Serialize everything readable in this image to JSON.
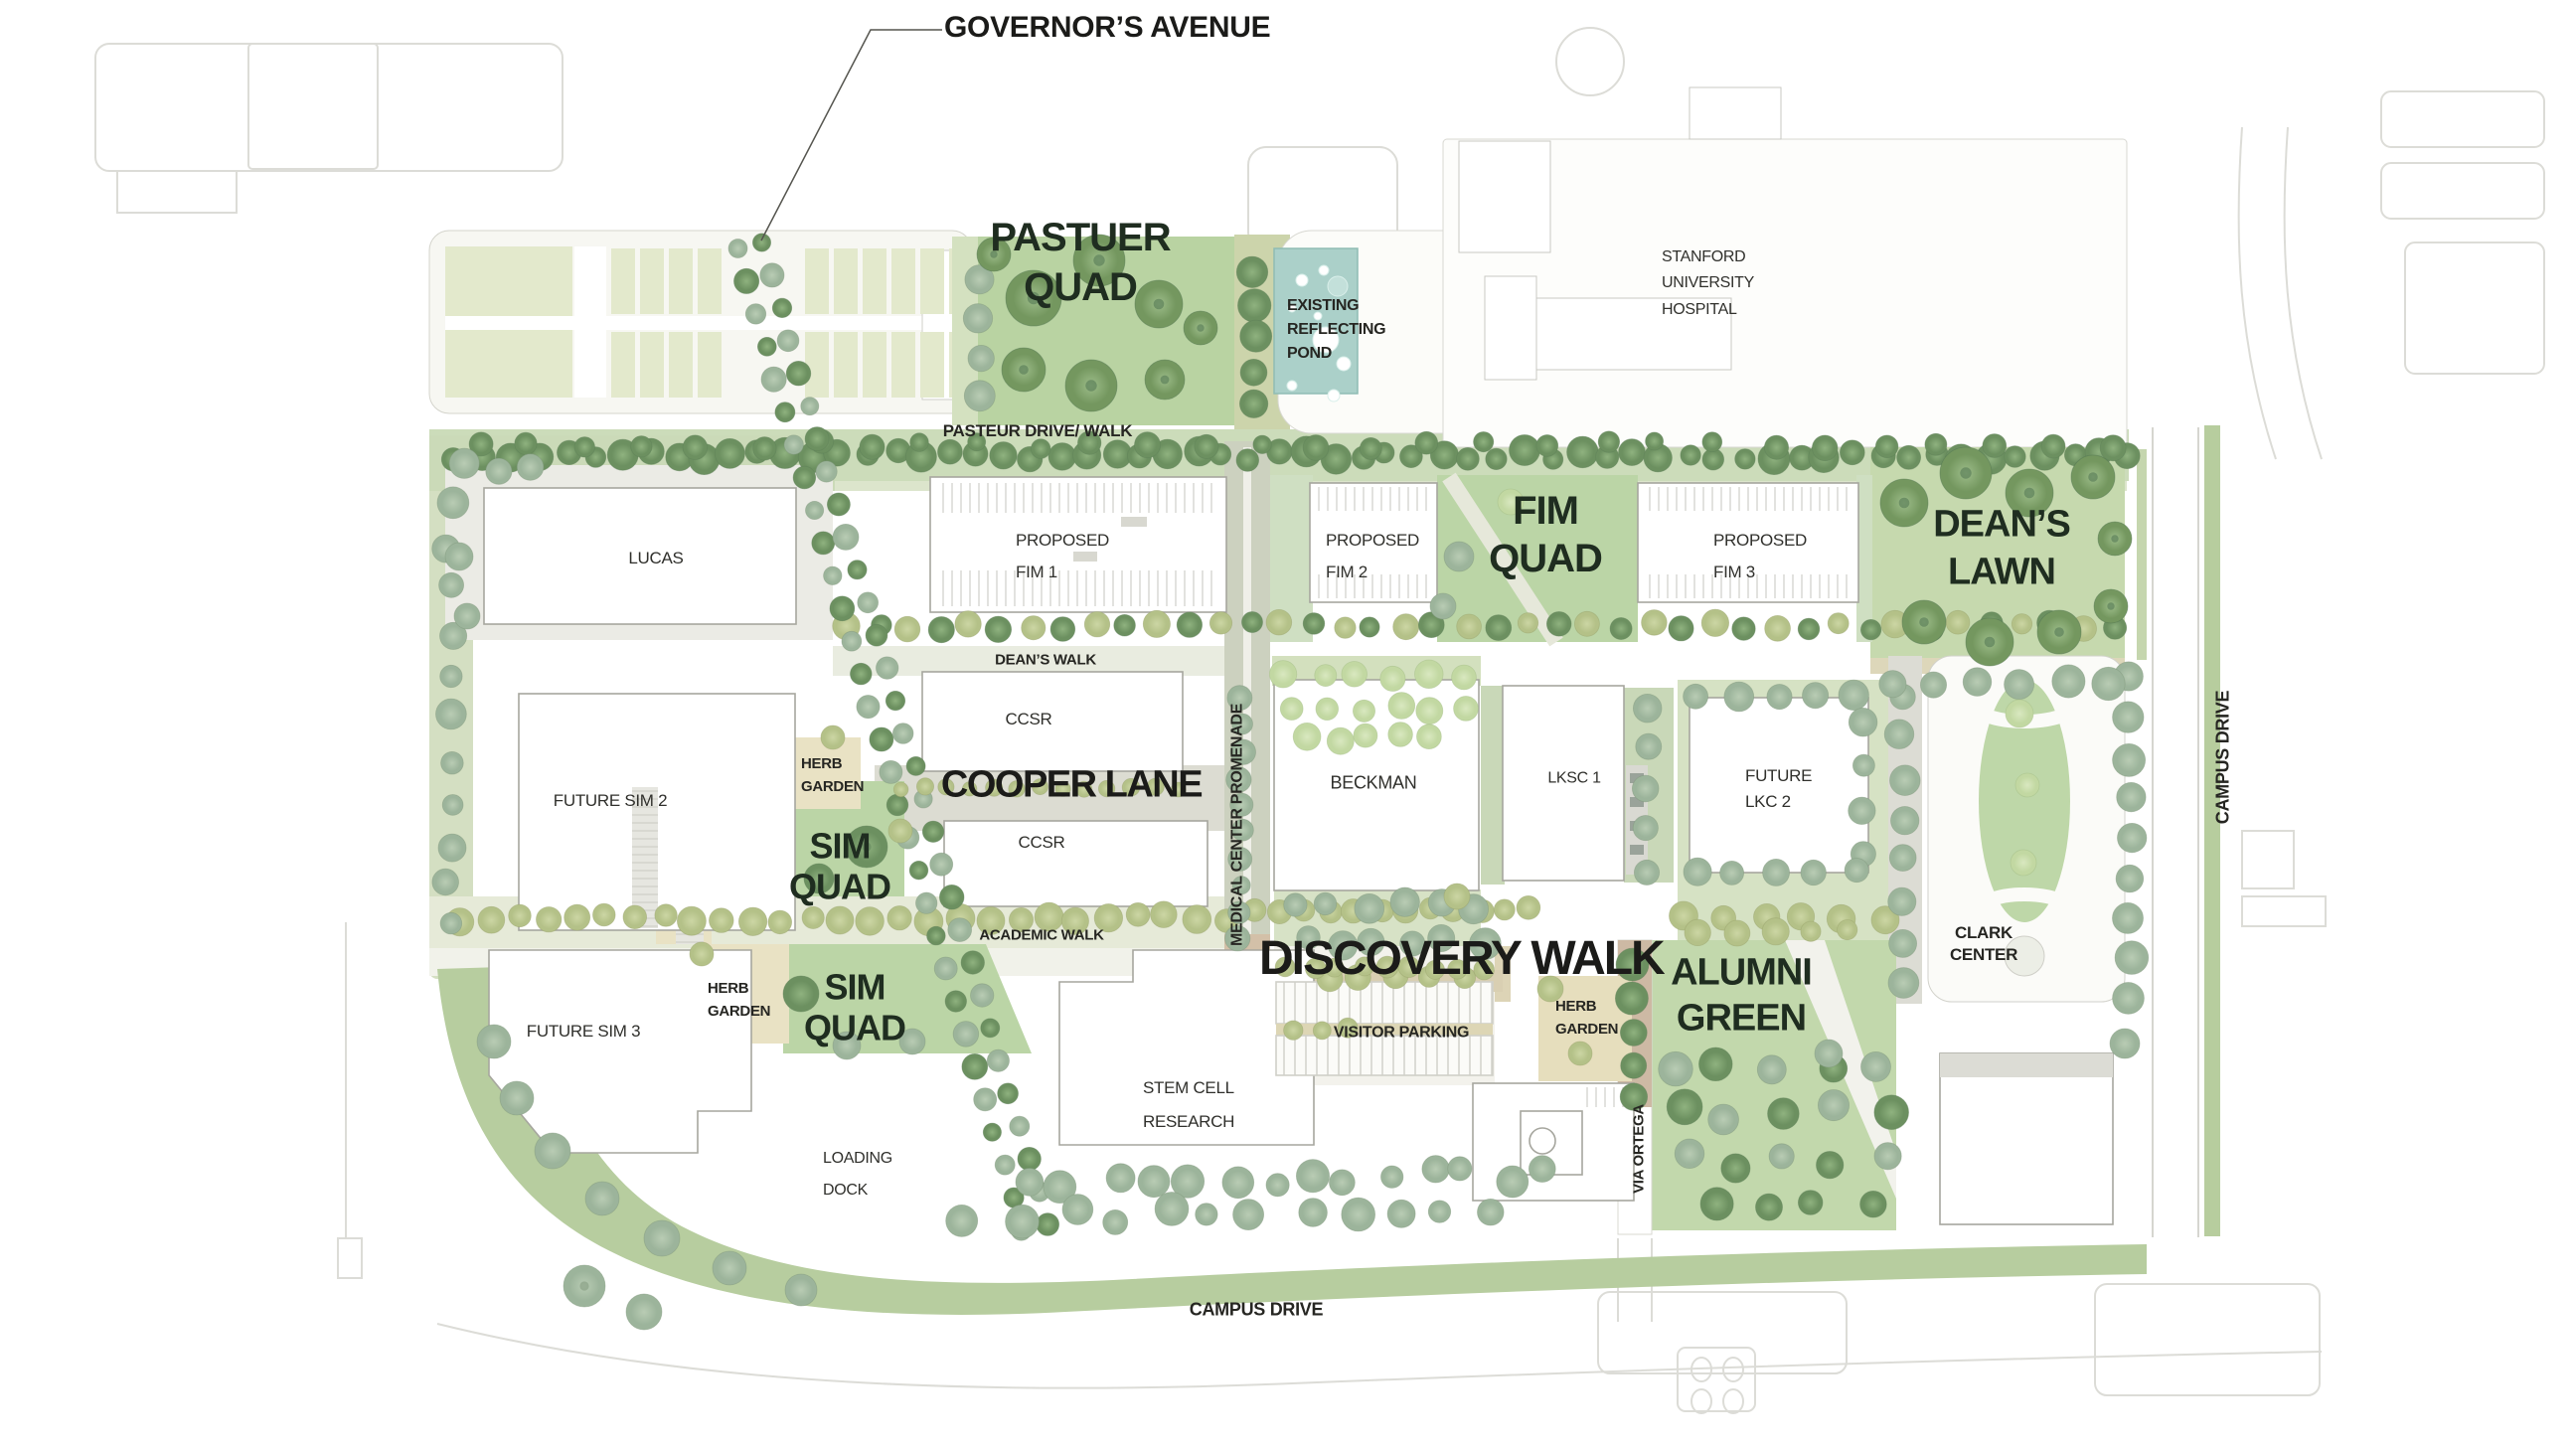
{
  "labels": {
    "governors_avenue": "GOVERNOR’S AVENUE",
    "pastuer_quad": "PASTUER\nQUAD",
    "existing_reflecting_pond": "EXISTING\nREFLECTING\nPOND",
    "stanford_university_hospital": "STANFORD\nUNIVERSITY\nHOSPITAL",
    "pasteur_drive_walk": "PASTEUR DRIVE/ WALK",
    "lucas": "LUCAS",
    "proposed_fim_1": "PROPOSED\nFIM 1",
    "proposed_fim_2": "PROPOSED\nFIM 2",
    "fim_quad": "FIM\nQUAD",
    "proposed_fim_3": "PROPOSED\nFIM 3",
    "deans_lawn": "DEAN’S\nLAWN",
    "deans_walk": "DEAN’S WALK",
    "ccsr_north": "CCSR",
    "cooper_lane": "COOPER LANE",
    "ccsr_south": "CCSR",
    "medical_center_promenade": "MEDICAL CENTER PROMENADE",
    "beckman": "BECKMAN",
    "lksc_1": "LKSC 1",
    "future_lkc_2": "FUTURE\nLKC 2",
    "campus_drive_east": "CAMPUS DRIVE",
    "herb_garden_west": "HERB\nGARDEN",
    "future_sim_2": "FUTURE SIM 2",
    "sim_quad_north": "SIM\nQUAD",
    "academic_walk": "ACADEMIC WALK",
    "discovery_walk": "DISCOVERY WALK",
    "alumni_green": "ALUMNI\nGREEN",
    "clark_center": "CLARK\nCENTER",
    "future_sim_3": "FUTURE SIM 3",
    "herb_garden_southwest": "HERB\nGARDEN",
    "sim_quad_south": "SIM\nQUAD",
    "visitor_parking": "VISITOR PARKING",
    "herb_garden_central": "HERB\nGARDEN",
    "stem_cell_research": "STEM CELL\nRESEARCH",
    "loading_dock": "LOADING\nDOCK",
    "via_ortega": "VIA ORTEGA",
    "campus_drive_south": "CAMPUS DRIVE"
  },
  "colors": {
    "quad_label": "#1f2d20",
    "street_label": "#1b1b19",
    "text": "#30302c",
    "quad_green": "#bbd5a6",
    "lawn_green": "#c6d9ae",
    "band_green": "#ccdcba",
    "pale_cell_green": "#e3e9cc",
    "pond_teal": "#abd0c9",
    "tan_walk": "#e9e2c4",
    "brick": "#cdb9a4",
    "building_outline": "#a6a69e",
    "context_line": "#dcdcd7"
  }
}
